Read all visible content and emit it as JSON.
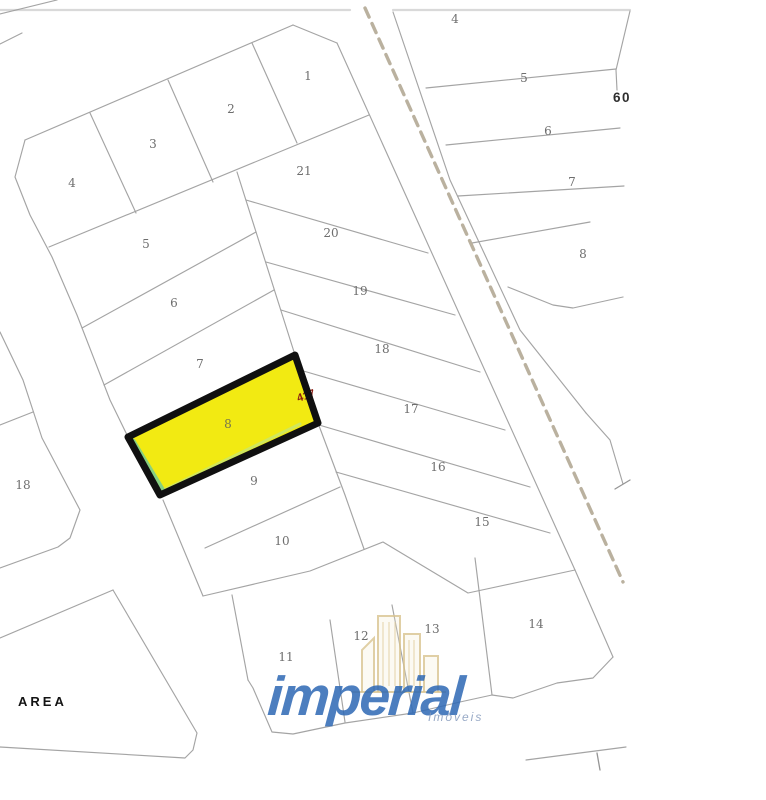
{
  "map": {
    "background": "#ffffff",
    "line_color": "#9f9f9f",
    "road": {
      "dash_color": "#b6ad9a",
      "centerline_points": "365,8 623,582"
    },
    "highlight": {
      "label": "8",
      "fill": "#f2ea12",
      "border_color": "#101010",
      "points": "295,355 318,423 160,495 128,437",
      "annotation": "417",
      "annotation_color": "#8b1d12",
      "annotation_x": 307,
      "annotation_y": 399,
      "annotation_rot": -18
    },
    "labels": [
      {
        "text": "1",
        "x": 308,
        "y": 80,
        "style": "plain"
      },
      {
        "text": "2",
        "x": 231,
        "y": 113,
        "style": "plain"
      },
      {
        "text": "3",
        "x": 153,
        "y": 148,
        "style": "plain"
      },
      {
        "text": "4",
        "x": 72,
        "y": 187,
        "style": "plain"
      },
      {
        "text": "21",
        "x": 304,
        "y": 175,
        "style": "plain"
      },
      {
        "text": "5",
        "x": 146,
        "y": 248,
        "style": "plain"
      },
      {
        "text": "20",
        "x": 331,
        "y": 237,
        "style": "plain"
      },
      {
        "text": "6",
        "x": 174,
        "y": 307,
        "style": "plain"
      },
      {
        "text": "19",
        "x": 360,
        "y": 295,
        "style": "plain"
      },
      {
        "text": "7",
        "x": 200,
        "y": 368,
        "style": "plain"
      },
      {
        "text": "18",
        "x": 382,
        "y": 353,
        "style": "plain"
      },
      {
        "text": "8",
        "x": 228,
        "y": 428,
        "style": "onyellow"
      },
      {
        "text": "17",
        "x": 411,
        "y": 413,
        "style": "plain"
      },
      {
        "text": "9",
        "x": 254,
        "y": 485,
        "style": "plain"
      },
      {
        "text": "16",
        "x": 438,
        "y": 471,
        "style": "plain"
      },
      {
        "text": "10",
        "x": 282,
        "y": 545,
        "style": "plain"
      },
      {
        "text": "15",
        "x": 482,
        "y": 526,
        "style": "plain"
      },
      {
        "text": "18",
        "x": 23,
        "y": 489,
        "style": "plain"
      },
      {
        "text": "11",
        "x": 286,
        "y": 661,
        "style": "plain"
      },
      {
        "text": "12",
        "x": 361,
        "y": 640,
        "style": "plain"
      },
      {
        "text": "13",
        "x": 432,
        "y": 633,
        "style": "plain"
      },
      {
        "text": "14",
        "x": 536,
        "y": 628,
        "style": "plain"
      },
      {
        "text": "4",
        "x": 455,
        "y": 23,
        "style": "plain"
      },
      {
        "text": "5",
        "x": 524,
        "y": 82,
        "style": "plain"
      },
      {
        "text": "6",
        "x": 548,
        "y": 135,
        "style": "plain"
      },
      {
        "text": "7",
        "x": 572,
        "y": 186,
        "style": "plain"
      },
      {
        "text": "8",
        "x": 583,
        "y": 258,
        "style": "plain"
      },
      {
        "text": "60",
        "x": 622,
        "y": 102,
        "style": "bold"
      },
      {
        "text": "AREA",
        "x": 18,
        "y": 706,
        "style": "area",
        "anchor": "start"
      }
    ],
    "lines": [
      {
        "name": "top-border-left",
        "type": "light",
        "points": "0,10 350,10"
      },
      {
        "name": "top-border-right",
        "type": "light",
        "points": "393,10 630,10"
      },
      {
        "name": "corner-line-a",
        "type": "solid",
        "points": "0,14 57,0"
      },
      {
        "name": "corner-line-b",
        "type": "solid",
        "points": "0,44 22,33"
      },
      {
        "name": "block-nw-boundary",
        "type": "solid",
        "points": "25,140 293,25"
      },
      {
        "name": "block-ne-chamfer",
        "type": "solid",
        "points": "293,25 337,43"
      },
      {
        "name": "block-west-boundary",
        "type": "solid",
        "points": "25,140 15,177 30,215 52,257 77,315 110,400 128,437"
      },
      {
        "name": "road-west-edge",
        "type": "solid",
        "points": "337,43 575,570"
      },
      {
        "name": "road-east-edge",
        "type": "solid",
        "points": "393,12 450,180 520,330 586,413"
      },
      {
        "name": "right-block-corner",
        "type": "solid",
        "points": "586,413 610,440 623,484"
      },
      {
        "name": "corner-tick",
        "type": "tick",
        "points": "615,489 630,480"
      },
      {
        "name": "right-block-east-edge",
        "type": "solid",
        "points": "630,11 616,70 617,90"
      },
      {
        "name": "top-row-bottom",
        "type": "solid",
        "points": "49,247 369,115"
      },
      {
        "name": "division-3-4",
        "type": "solid",
        "points": "90,113 136,213"
      },
      {
        "name": "division-2-3",
        "type": "solid",
        "points": "168,80 213,182"
      },
      {
        "name": "division-1-2",
        "type": "solid",
        "points": "252,43 297,143"
      },
      {
        "name": "block-spine",
        "type": "solid",
        "points": "237,172 295,355 318,423 345,495 364,549"
      },
      {
        "name": "division-21-20",
        "type": "solid",
        "points": "246,200 428,253"
      },
      {
        "name": "division-20-19",
        "type": "solid",
        "points": "266,262 455,315"
      },
      {
        "name": "division-19-18",
        "type": "solid",
        "points": "281,310 480,372"
      },
      {
        "name": "division-18-17",
        "type": "solid",
        "points": "300,370 505,430"
      },
      {
        "name": "division-17-16",
        "type": "solid",
        "points": "319,425 530,487"
      },
      {
        "name": "division-16-15",
        "type": "solid",
        "points": "336,472 550,533"
      },
      {
        "name": "division-5-6",
        "type": "solid",
        "points": "82,328 256,232"
      },
      {
        "name": "division-6-7",
        "type": "solid",
        "points": "104,385 274,290"
      },
      {
        "name": "division-9-10",
        "type": "solid",
        "points": "205,548 340,487"
      },
      {
        "name": "street-edge-lot9",
        "type": "solid",
        "points": "163,500 203,596"
      },
      {
        "name": "south-boundary",
        "type": "solid",
        "points": "203,596 310,571 383,542 468,593 575,570 613,657"
      },
      {
        "name": "division-11-12",
        "type": "solid",
        "points": "330,620 345,722"
      },
      {
        "name": "division-12-13",
        "type": "solid",
        "points": "392,605 413,713"
      },
      {
        "name": "division-13-14",
        "type": "solid",
        "points": "475,558 492,695"
      },
      {
        "name": "bottom-row-frontage",
        "type": "solid",
        "points": "248,680 253,688 272,732 293,734 345,723 413,713 460,702 492,695 513,698 557,683 593,678 613,657"
      },
      {
        "name": "lot11-west-edge",
        "type": "solid",
        "points": "232,595 248,680"
      },
      {
        "name": "lot18-ne-boundary",
        "type": "solid",
        "points": "0,332 23,380 42,438 80,510 70,538 58,547 0,568"
      },
      {
        "name": "lot18-top-edge",
        "type": "solid",
        "points": "0,425 33,412"
      },
      {
        "name": "area-parcel-boundary",
        "type": "solid",
        "points": "113,590 197,733 193,750 185,758 0,747"
      },
      {
        "name": "area-parcel-nw-edge",
        "type": "solid",
        "points": "113,590 0,638"
      },
      {
        "name": "rb-division-4-5",
        "type": "solid",
        "points": "426,88 616,69"
      },
      {
        "name": "rb-division-5-6",
        "type": "solid",
        "points": "446,145 620,128"
      },
      {
        "name": "rb-division-6-7",
        "type": "solid",
        "points": "458,196 624,186"
      },
      {
        "name": "rb-division-7-8",
        "type": "solid",
        "points": "472,243 590,222"
      },
      {
        "name": "rb-lot8-bottom",
        "type": "solid",
        "points": "508,287 553,305 573,308 623,297"
      },
      {
        "name": "bottom-survey-line",
        "type": "solid",
        "points": "526,760 626,747"
      },
      {
        "name": "bottom-survey-tick",
        "type": "tick",
        "points": "597,753 600,770"
      }
    ],
    "watermark": {
      "text": "imperial",
      "subtext": "Imóveis",
      "color": "#2f69b5",
      "icon": "buildings-icon"
    }
  }
}
